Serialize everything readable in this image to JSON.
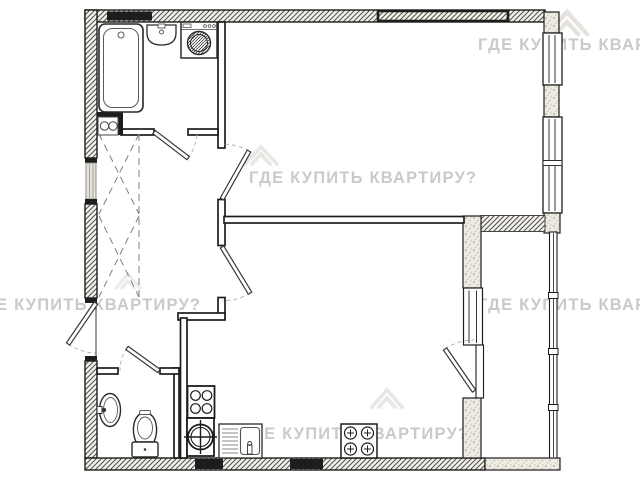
{
  "watermark": {
    "text": "ГДЕ КУПИТЬ КВАРТИРУ?",
    "color": "#c7c4c0",
    "logo_color": "#dcd9d4"
  },
  "plan": {
    "kind": "one-room apartment floor plan",
    "colors": {
      "line": "#1d1d1d",
      "paper": "#ffffff",
      "wall_black": "#1d1d1d",
      "hatch_line": "#55514b",
      "stipple_fill": "#edeae1"
    },
    "fixtures": {
      "bathroom": [
        "bathtub",
        "washbasin",
        "washing-machine",
        "cabinet-two-knobs"
      ],
      "wc": [
        "corner-washbasin",
        "toilet"
      ],
      "kitchen": [
        "electric-stove-4-burner",
        "round-hob",
        "sink-with-drainboard",
        "gas-stove-4-burner"
      ],
      "hallway": [
        "built-in-wardrobe-dashed"
      ],
      "doors": [
        "entrance-door",
        "bathroom-door",
        "wc-door",
        "living-room-door",
        "kitchen-door",
        "balcony-door"
      ],
      "windows": [
        "window-upper-right",
        "window-lower-right",
        "kitchen-window",
        "loggia-glazing"
      ]
    }
  }
}
